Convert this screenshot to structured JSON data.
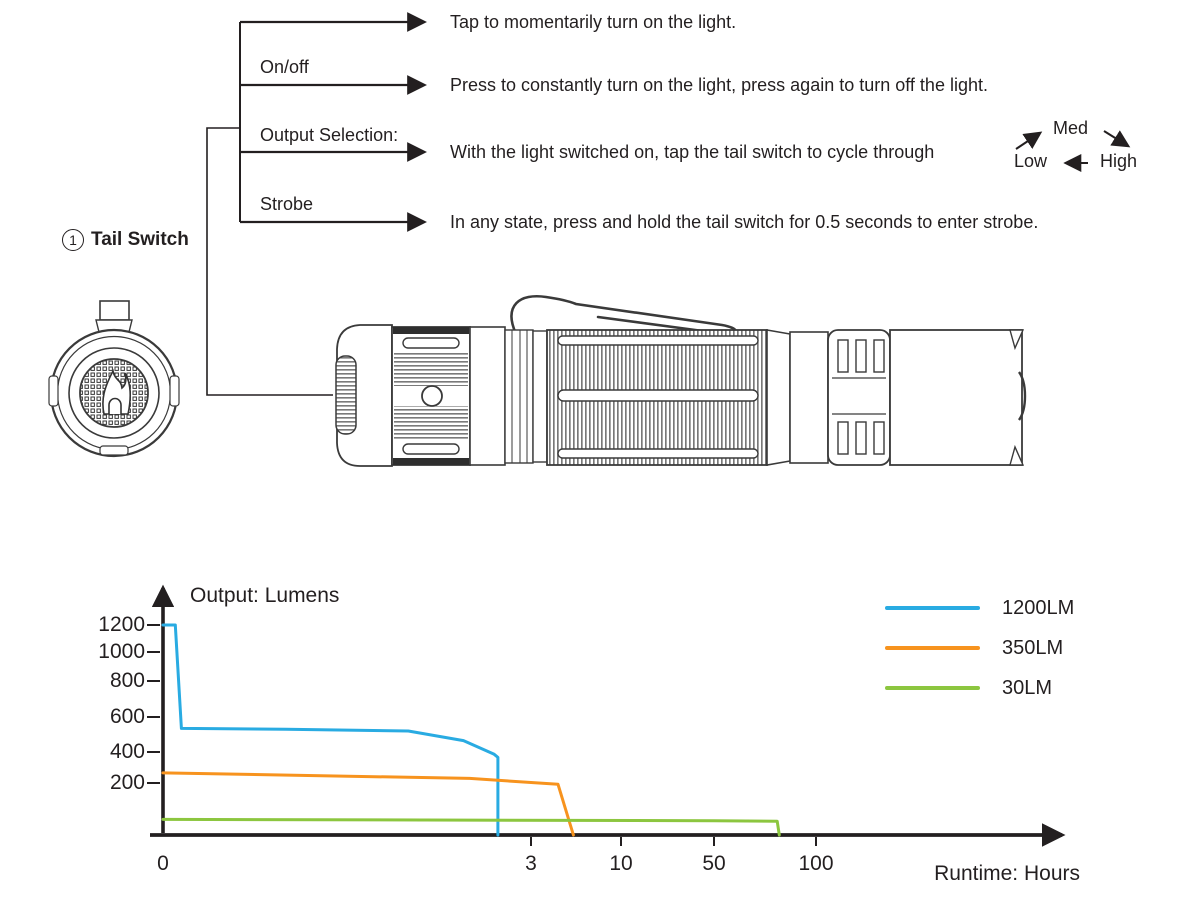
{
  "part": {
    "marker": "1",
    "label": "Tail Switch"
  },
  "tree": {
    "branches": [
      {
        "label": "",
        "text": "Tap to momentarily turn on the light."
      },
      {
        "label": "On/off",
        "text": "Press to constantly turn on the light, press again to turn off the light."
      },
      {
        "label": "Output Selection:",
        "text": "With the light switched on, tap the tail switch to cycle through"
      },
      {
        "label": "Strobe",
        "text": "In any state, press and hold the tail switch for 0.5 seconds to enter strobe."
      }
    ],
    "cycle": {
      "med": "Med",
      "low": "Low",
      "high": "High"
    }
  },
  "chart_data": {
    "type": "line",
    "ylabel": "Output: Lumens",
    "xlabel": "Runtime: Hours",
    "x_tick_labels": [
      "0",
      "3",
      "10",
      "50",
      "100"
    ],
    "y_tick_labels": [
      "1200",
      "1000",
      "800",
      "600",
      "400",
      "200"
    ],
    "x_axis_note": "non-linear hours scale (0,3,10,50,100)",
    "ylim": [
      0,
      1300
    ],
    "grid": false,
    "legend_position": "top-right",
    "series": [
      {
        "name": "1200LM",
        "color": "#29abe2",
        "points": [
          [
            0,
            1200
          ],
          [
            0.1,
            1200
          ],
          [
            0.15,
            535
          ],
          [
            1.0,
            530
          ],
          [
            2.0,
            520
          ],
          [
            2.45,
            465
          ],
          [
            2.7,
            385
          ],
          [
            2.73,
            365
          ],
          [
            2.73,
            0
          ]
        ]
      },
      {
        "name": "350LM",
        "color": "#f7931e",
        "points": [
          [
            0,
            265
          ],
          [
            2.5,
            230
          ],
          [
            5.1,
            195
          ],
          [
            6.3,
            0
          ]
        ]
      },
      {
        "name": "30LM",
        "color": "#8cc63f",
        "points": [
          [
            0,
            60
          ],
          [
            50,
            55
          ],
          [
            81,
            53
          ],
          [
            82,
            0
          ]
        ]
      }
    ]
  }
}
